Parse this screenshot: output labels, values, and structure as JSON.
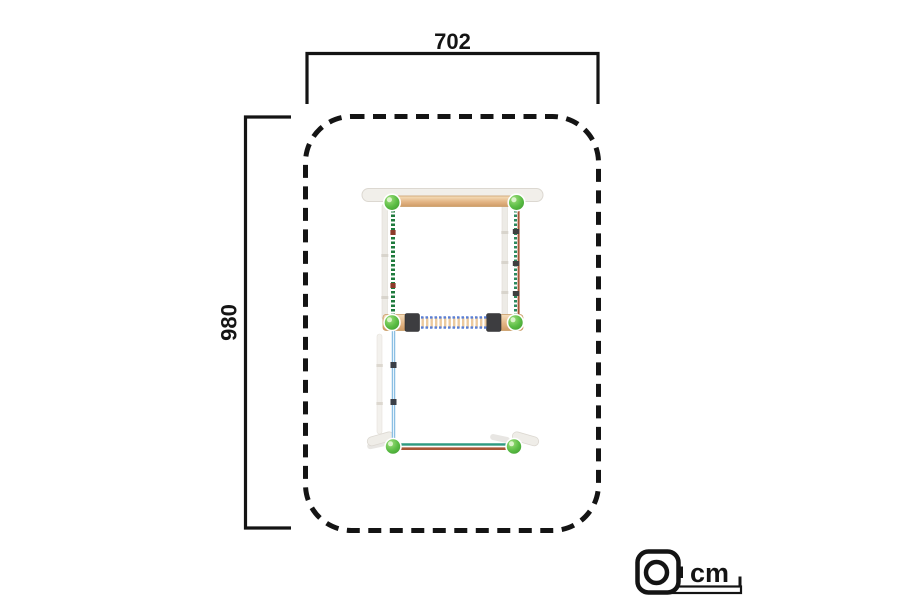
{
  "labels": {
    "top_dimension": "702",
    "left_dimension": "980",
    "unit": "cm"
  },
  "icons": {
    "unit_icon": "tape-measure-icon"
  },
  "diagram": {
    "type": "top-view-dimension-drawing",
    "safety_zone_width_cm": 702,
    "safety_zone_depth_cm": 980,
    "boundary_style": "dashed-rounded-rectangle"
  },
  "colors": {
    "line_black": "#141414",
    "ball_green": "#5cc24e",
    "wood_tan": "#e3b585",
    "rope_green": "#1e7a3c",
    "rope_red": "#a85636",
    "rope_light_blue": "#8bbfe3",
    "ladder_blue": "#5a7fd6",
    "teal": "#2f9a80",
    "frame_white": "#f1efea",
    "clamp_dark": "#3d3d40"
  }
}
